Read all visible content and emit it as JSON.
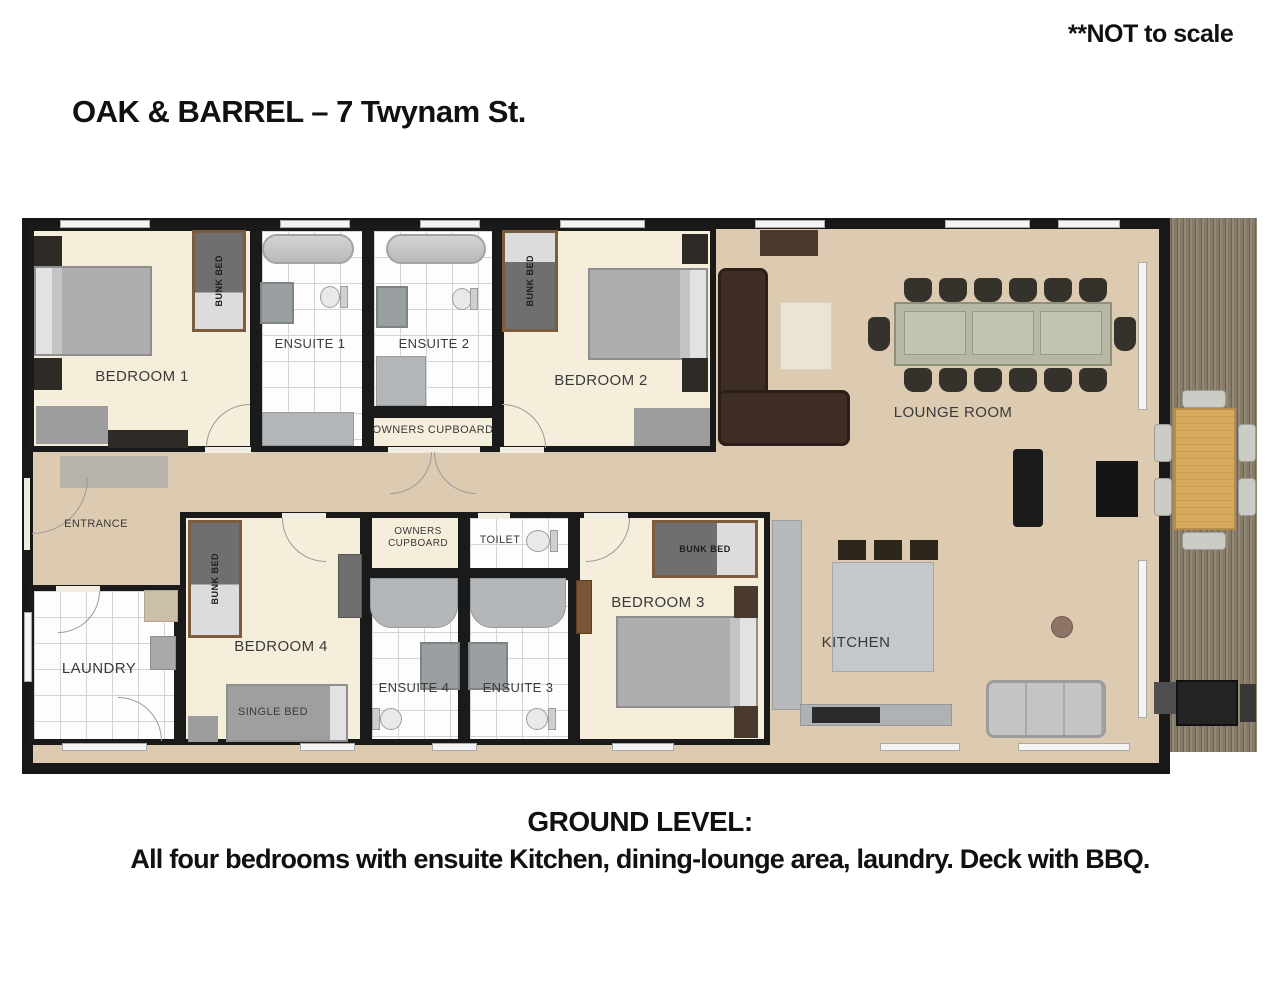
{
  "header": {
    "note": "**NOT to scale",
    "title": "OAK & BARREL – 7 Twynam St."
  },
  "rooms": {
    "bedroom1": {
      "label": "BEDROOM 1"
    },
    "ensuite1": {
      "label": "ENSUITE 1"
    },
    "ensuite2": {
      "label": "ENSUITE 2"
    },
    "owners_cupboard_top": {
      "label": "OWNERS CUPBOARD"
    },
    "bedroom2": {
      "label": "BEDROOM 2"
    },
    "lounge": {
      "label": "LOUNGE ROOM"
    },
    "entrance": {
      "label": "ENTRANCE"
    },
    "laundry": {
      "label": "LAUNDRY"
    },
    "bedroom4": {
      "label": "BEDROOM 4"
    },
    "owners_cupboard_bottom": {
      "line1": "OWNERS",
      "line2": "CUPBOARD"
    },
    "toilet": {
      "label": "TOILET"
    },
    "ensuite4": {
      "label": "ENSUITE 4"
    },
    "ensuite3": {
      "label": "ENSUITE 3"
    },
    "bedroom3": {
      "label": "BEDROOM 3"
    },
    "kitchen": {
      "label": "KITCHEN"
    }
  },
  "furniture": {
    "bunk_bed_label": "BUNK BED",
    "single_bed_label": "SINGLE BED"
  },
  "caption": {
    "line1": "GROUND LEVEL:",
    "line2": "All four bedrooms with ensuite Kitchen, dining-lounge area, laundry.  Deck with BBQ."
  },
  "colors": {
    "wall": "#181818",
    "open_floor": "#dccab1",
    "room_floor": "#f5eedb",
    "deck_wood": "#867a69",
    "sofa_brown": "#3e2e26",
    "deck_table": "#d2a45c"
  }
}
